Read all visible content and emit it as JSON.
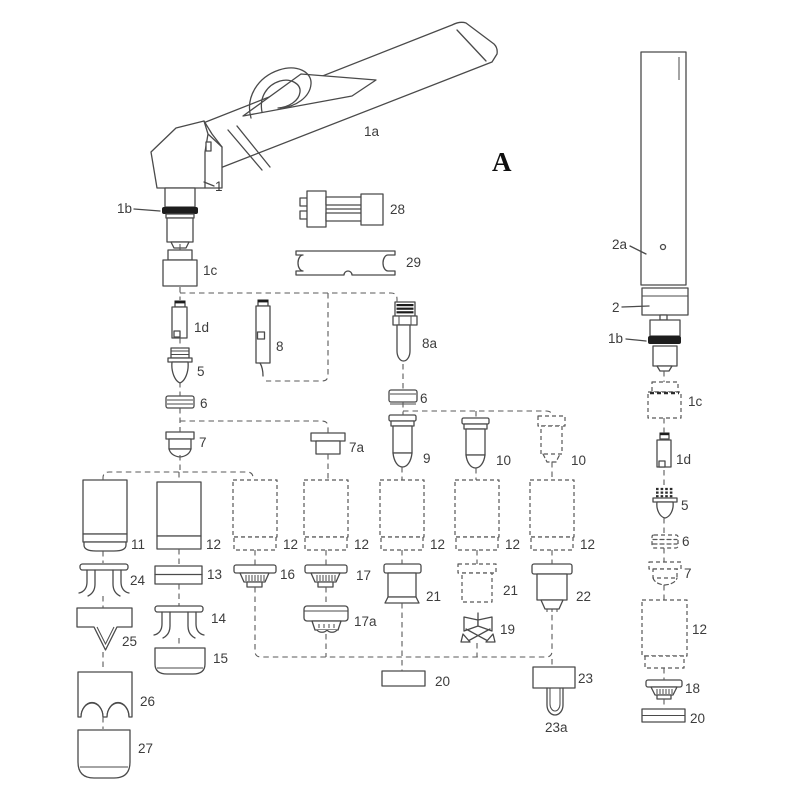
{
  "figure": {
    "letter": "A"
  },
  "colors": {
    "ink": "#4a4a4a",
    "background": "#ffffff",
    "dark_band": "#1d1d1d"
  },
  "labels": {
    "p1a": "1a",
    "p1": "1",
    "p1b_l": "1b",
    "p1c_l": "1c",
    "p1d_l": "1d",
    "p5_l": "5",
    "p6_l": "6",
    "p7_l": "7",
    "p28": "28",
    "p29": "29",
    "p8": "8",
    "p8a": "8a",
    "p6_m": "6",
    "p7a": "7a",
    "p9": "9",
    "p10": "10",
    "p10d": "10",
    "p11": "11",
    "p12_c2": "12",
    "p12_c3": "12",
    "p12_c4": "12",
    "p12_c5": "12",
    "p12_c6": "12",
    "p12_c7": "12",
    "p12_r": "12",
    "p13": "13",
    "p14": "14",
    "p15": "15",
    "p16": "16",
    "p17": "17",
    "p17a": "17a",
    "p19": "19",
    "p20_m": "20",
    "p20_r": "20",
    "p21": "21",
    "p21d": "21",
    "p22": "22",
    "p23": "23",
    "p23a": "23a",
    "p24": "24",
    "p25": "25",
    "p26": "26",
    "p27": "27",
    "p2a": "2a",
    "p2": "2",
    "p1b_r": "1b",
    "p1c_r": "1c",
    "p1d_r": "1d",
    "p5_r": "5",
    "p6_r": "6",
    "p7_r": "7",
    "p18": "18"
  }
}
